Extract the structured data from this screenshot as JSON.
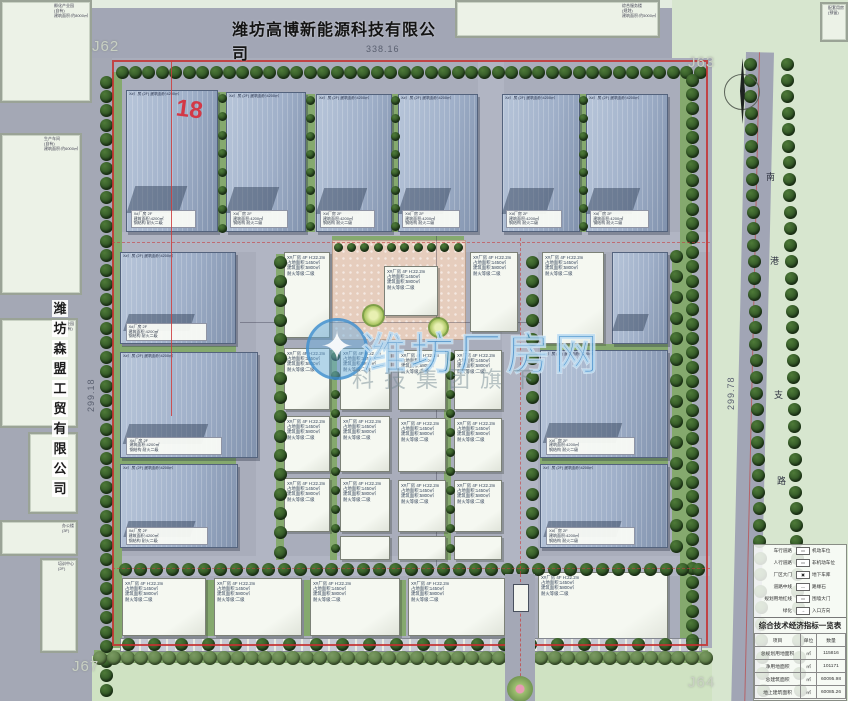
{
  "header": {
    "title": "潍坊高博新能源科技有限公司"
  },
  "west_company": {
    "name": "潍坊森盟工贸有限公司",
    "chars": [
      "潍",
      "坊",
      "森",
      "盟",
      "工",
      "贸",
      "有",
      "限",
      "公",
      "司"
    ]
  },
  "watermark": {
    "main": "潍坊厂房网",
    "sub": "科技集团旗下",
    "logo_icon": "gear-compass-icon",
    "color": "#3e8ece"
  },
  "dimensions": {
    "top": "338.16",
    "left": "299.18",
    "right": "299.78"
  },
  "corner_labels": {
    "tl": "J62",
    "tr": "J63",
    "br": "J64",
    "bl": "J67"
  },
  "annotation_red": "18",
  "right_road": {
    "name": "南港支路",
    "chars": [
      {
        "c": "南",
        "x": 766,
        "y": 170
      },
      {
        "c": "港",
        "x": 770,
        "y": 254
      },
      {
        "c": "支",
        "x": 774,
        "y": 388
      },
      {
        "c": "路",
        "x": 777,
        "y": 474
      }
    ]
  },
  "building_text": {
    "blue_top_line": "X#厂房 (2F) 建筑面积:4200㎡",
    "blue_label_lines": [
      "X#厂房 2F",
      "建筑面积:4200㎡",
      "钢结构 耐火二级"
    ],
    "white_spec_lines": [
      "X#厂房 4F H:22.2m",
      "占地面积:1450㎡",
      "建筑面积:5800㎡",
      "耐火等级:二级"
    ]
  },
  "outside_buildings": [
    {
      "x": 0,
      "y": 0,
      "w": 92,
      "h": 103,
      "label": [
        "孵化产业园",
        "(自有)",
        "建筑面积:约8000㎡"
      ]
    },
    {
      "x": 455,
      "y": 0,
      "w": 205,
      "h": 38,
      "label": [
        "综合服务楼",
        "(规划)",
        "建筑面积:约5000㎡"
      ]
    },
    {
      "x": 820,
      "y": 2,
      "w": 28,
      "h": 40,
      "label": [
        "配套用房",
        "(预留)"
      ]
    },
    {
      "x": 0,
      "y": 133,
      "w": 82,
      "h": 162,
      "label": [
        "生产车间",
        "(自有)",
        "建筑面积:约6000㎡"
      ]
    },
    {
      "x": 0,
      "y": 318,
      "w": 78,
      "h": 110,
      "label": [
        "产业园",
        "(自有)"
      ]
    },
    {
      "x": 28,
      "y": 432,
      "w": 50,
      "h": 82,
      "label": []
    },
    {
      "x": 0,
      "y": 520,
      "w": 78,
      "h": 36,
      "label": [
        "办公楼",
        "(3F)"
      ]
    },
    {
      "x": 40,
      "y": 558,
      "w": 38,
      "h": 95,
      "label": [
        "培训中心",
        "(2F)"
      ]
    }
  ],
  "buildings": [
    {
      "x": 126,
      "y": 90,
      "w": 92,
      "h": 142,
      "t": "blue"
    },
    {
      "x": 226,
      "y": 92,
      "w": 80,
      "h": 140,
      "t": "blue"
    },
    {
      "x": 316,
      "y": 94,
      "w": 76,
      "h": 138,
      "t": "blue"
    },
    {
      "x": 398,
      "y": 94,
      "w": 80,
      "h": 138,
      "t": "blue"
    },
    {
      "x": 502,
      "y": 94,
      "w": 78,
      "h": 138,
      "t": "blue"
    },
    {
      "x": 586,
      "y": 94,
      "w": 82,
      "h": 138,
      "t": "blue"
    },
    {
      "x": 120,
      "y": 252,
      "w": 116,
      "h": 92,
      "t": "blue"
    },
    {
      "x": 120,
      "y": 352,
      "w": 138,
      "h": 106,
      "t": "blue"
    },
    {
      "x": 120,
      "y": 464,
      "w": 118,
      "h": 84,
      "t": "blue"
    },
    {
      "x": 542,
      "y": 252,
      "w": 62,
      "h": 92,
      "t": "white"
    },
    {
      "x": 612,
      "y": 252,
      "w": 56,
      "h": 92,
      "t": "blue"
    },
    {
      "x": 540,
      "y": 350,
      "w": 128,
      "h": 108,
      "t": "blue"
    },
    {
      "x": 540,
      "y": 464,
      "w": 128,
      "h": 84,
      "t": "blue"
    },
    {
      "x": 284,
      "y": 252,
      "w": 46,
      "h": 86,
      "t": "white"
    },
    {
      "x": 470,
      "y": 252,
      "w": 48,
      "h": 80,
      "t": "white"
    },
    {
      "x": 284,
      "y": 348,
      "w": 46,
      "h": 62,
      "t": "white"
    },
    {
      "x": 340,
      "y": 348,
      "w": 50,
      "h": 62,
      "t": "white"
    },
    {
      "x": 398,
      "y": 350,
      "w": 48,
      "h": 60,
      "t": "white"
    },
    {
      "x": 454,
      "y": 350,
      "w": 48,
      "h": 60,
      "t": "white"
    },
    {
      "x": 284,
      "y": 416,
      "w": 46,
      "h": 56,
      "t": "white"
    },
    {
      "x": 340,
      "y": 416,
      "w": 50,
      "h": 56,
      "t": "white"
    },
    {
      "x": 398,
      "y": 418,
      "w": 48,
      "h": 54,
      "t": "white"
    },
    {
      "x": 454,
      "y": 418,
      "w": 48,
      "h": 54,
      "t": "white"
    },
    {
      "x": 284,
      "y": 478,
      "w": 46,
      "h": 54,
      "t": "white"
    },
    {
      "x": 340,
      "y": 478,
      "w": 50,
      "h": 54,
      "t": "white"
    },
    {
      "x": 398,
      "y": 480,
      "w": 48,
      "h": 52,
      "t": "white"
    },
    {
      "x": 454,
      "y": 480,
      "w": 48,
      "h": 52,
      "t": "white"
    },
    {
      "x": 340,
      "y": 536,
      "w": 50,
      "h": 24,
      "t": "white"
    },
    {
      "x": 398,
      "y": 536,
      "w": 48,
      "h": 24,
      "t": "white"
    },
    {
      "x": 454,
      "y": 536,
      "w": 48,
      "h": 24,
      "t": "white"
    },
    {
      "x": 122,
      "y": 578,
      "w": 84,
      "h": 58,
      "t": "white"
    },
    {
      "x": 214,
      "y": 578,
      "w": 88,
      "h": 58,
      "t": "white"
    },
    {
      "x": 310,
      "y": 578,
      "w": 90,
      "h": 58,
      "t": "white"
    },
    {
      "x": 408,
      "y": 578,
      "w": 97,
      "h": 58,
      "t": "white"
    },
    {
      "x": 538,
      "y": 572,
      "w": 130,
      "h": 70,
      "t": "white"
    },
    {
      "x": 384,
      "y": 266,
      "w": 54,
      "h": 50,
      "t": "white"
    }
  ],
  "tree_rows": [
    [
      122,
      72,
      700,
      72,
      44,
      0
    ],
    [
      106,
      82,
      106,
      690,
      43,
      0
    ],
    [
      692,
      80,
      692,
      640,
      40,
      0
    ],
    [
      100,
      658,
      706,
      658,
      45,
      1
    ],
    [
      128,
      644,
      692,
      644,
      22,
      0
    ],
    [
      750,
      64,
      763,
      690,
      39,
      0
    ],
    [
      787,
      64,
      800,
      690,
      39,
      0
    ],
    [
      338,
      247,
      458,
      247,
      10,
      2
    ],
    [
      280,
      262,
      280,
      552,
      16,
      0
    ],
    [
      532,
      262,
      532,
      552,
      16,
      0
    ],
    [
      222,
      98,
      222,
      228,
      8,
      2
    ],
    [
      310,
      100,
      310,
      226,
      8,
      2
    ],
    [
      395,
      100,
      395,
      226,
      8,
      2
    ],
    [
      583,
      100,
      583,
      226,
      8,
      2
    ],
    [
      335,
      356,
      335,
      548,
      11,
      2
    ],
    [
      450,
      356,
      450,
      548,
      11,
      2
    ],
    [
      125,
      569,
      698,
      569,
      37,
      0
    ],
    [
      676,
      256,
      676,
      546,
      15,
      0
    ]
  ],
  "green_strips": [
    [
      112,
      72,
      10,
      576
    ],
    [
      680,
      74,
      12,
      566
    ],
    [
      218,
      92,
      8,
      140
    ],
    [
      306,
      94,
      9,
      138
    ],
    [
      392,
      94,
      6,
      138
    ],
    [
      580,
      94,
      6,
      138
    ],
    [
      94,
      650,
      614,
      13
    ],
    [
      332,
      236,
      132,
      14
    ],
    [
      276,
      254,
      8,
      306
    ],
    [
      330,
      350,
      7,
      210
    ],
    [
      444,
      352,
      7,
      208
    ],
    [
      120,
      346,
      116,
      6
    ],
    [
      120,
      456,
      116,
      8
    ],
    [
      540,
      344,
      128,
      6
    ],
    [
      540,
      456,
      128,
      8
    ],
    [
      206,
      580,
      8,
      56
    ],
    [
      304,
      580,
      6,
      56
    ],
    [
      400,
      580,
      6,
      56
    ],
    [
      672,
      254,
      8,
      298
    ]
  ],
  "inner_roads": [
    [
      256,
      234,
      28,
      344
    ],
    [
      502,
      234,
      36,
      344
    ],
    [
      112,
      232,
      598,
      20
    ],
    [
      112,
      556,
      598,
      20
    ],
    [
      478,
      60,
      26,
      174
    ]
  ],
  "survey_lines": [
    {
      "x": 171,
      "y": 60,
      "w": 1,
      "h": 356,
      "kind": "red-solid"
    },
    {
      "x": 520,
      "y": 238,
      "w": 1,
      "h": 336,
      "kind": "red-dash"
    },
    {
      "x": 112,
      "y": 242,
      "w": 598,
      "h": 1,
      "kind": "red-dash"
    },
    {
      "x": 112,
      "y": 568,
      "w": 598,
      "h": 1,
      "kind": "red-dash"
    },
    {
      "x": 240,
      "y": 322,
      "w": 300,
      "h": 1,
      "kind": "faint"
    },
    {
      "x": 436,
      "y": 236,
      "w": 1,
      "h": 330,
      "kind": "faint"
    }
  ],
  "legend": {
    "rows": [
      {
        "left": "车行道路",
        "swatch": "▭",
        "right": "机动车位"
      },
      {
        "left": "人行道路",
        "swatch": "▭",
        "right": "非机动车位"
      },
      {
        "left": "厂区大门",
        "swatch": "▣",
        "right": "地下车库"
      },
      {
        "left": "道路中线",
        "swatch": "—",
        "right": "路缘石"
      },
      {
        "left": "规划用地红线",
        "swatch": "▭",
        "right": "围墙大门"
      },
      {
        "left": "绿化",
        "swatch": "→",
        "right": "入口方向"
      }
    ]
  },
  "indicator_table": {
    "title": "综合技术经济指标一览表",
    "headers": [
      "项目",
      "单位",
      "数量"
    ],
    "rows": [
      [
        "总规划用地面积",
        "㎡",
        "115816"
      ],
      [
        "净用地面积",
        "㎡",
        "101171"
      ],
      [
        "总建筑面积",
        "㎡",
        "60095.98"
      ],
      [
        "地上建筑面积",
        "㎡",
        "60085.26"
      ]
    ]
  }
}
